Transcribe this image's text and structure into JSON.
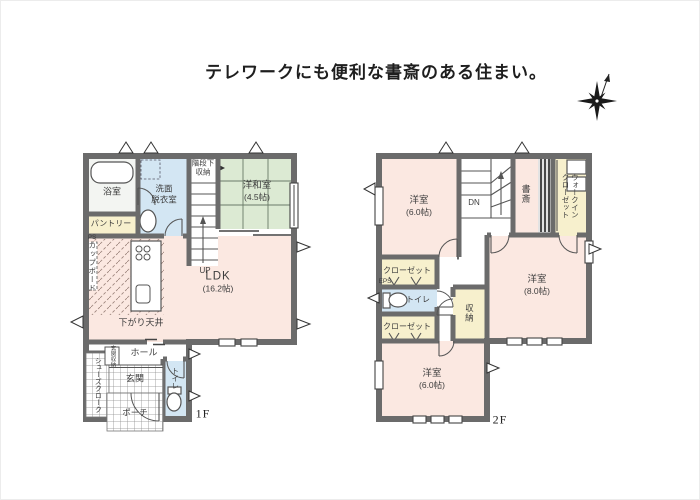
{
  "title": "テレワークにも便利な書斎のある住まい。",
  "colors": {
    "room_pink": "#fbe8e1",
    "tatami_green": "#dcead3",
    "wet_blue": "#d3e6f3",
    "closet_cream": "#f7f0cd",
    "bath_grey": "#f3f5f2",
    "wall": "#6b6b6b",
    "label_text": "#3d3d3d"
  },
  "floor1": {
    "floor_label": "1F",
    "labels": {
      "bath": "浴室",
      "washroom_line1": "洗面",
      "washroom_line2": "脱衣室",
      "stair_storage_line1": "階段下",
      "stair_storage_line2": "収納",
      "up": "UP",
      "tatami_room": "洋和室",
      "tatami_size": "(4.5帖)",
      "pantry": "パントリー",
      "ps": "PS",
      "cupboard": "カップボード",
      "ldk": "LDK",
      "ldk_size": "(16.2帖)",
      "lowered_ceiling": "下がり天井",
      "hall": "ホール",
      "entrance_storage": "玄関収納",
      "shoes_closet": "シューズクローク",
      "entrance": "玄関",
      "porch": "ポーチ",
      "toilet": "トイレ"
    }
  },
  "floor2": {
    "floor_label": "2F",
    "labels": {
      "bedroom_nw": "洋室",
      "bedroom_nw_size": "(6.0帖)",
      "dn": "DN",
      "study": "書斎",
      "wic_line1": "ウォークイン",
      "wic_line2": "クローゼット",
      "closet_north": "クローゼット",
      "eps": "EPS",
      "toilet": "トイレ",
      "closet_south": "クローゼット",
      "storage": "収納",
      "bedroom_east": "洋室",
      "bedroom_east_size": "(8.0帖)",
      "bedroom_south": "洋室",
      "bedroom_south_size": "(6.0帖)"
    }
  }
}
